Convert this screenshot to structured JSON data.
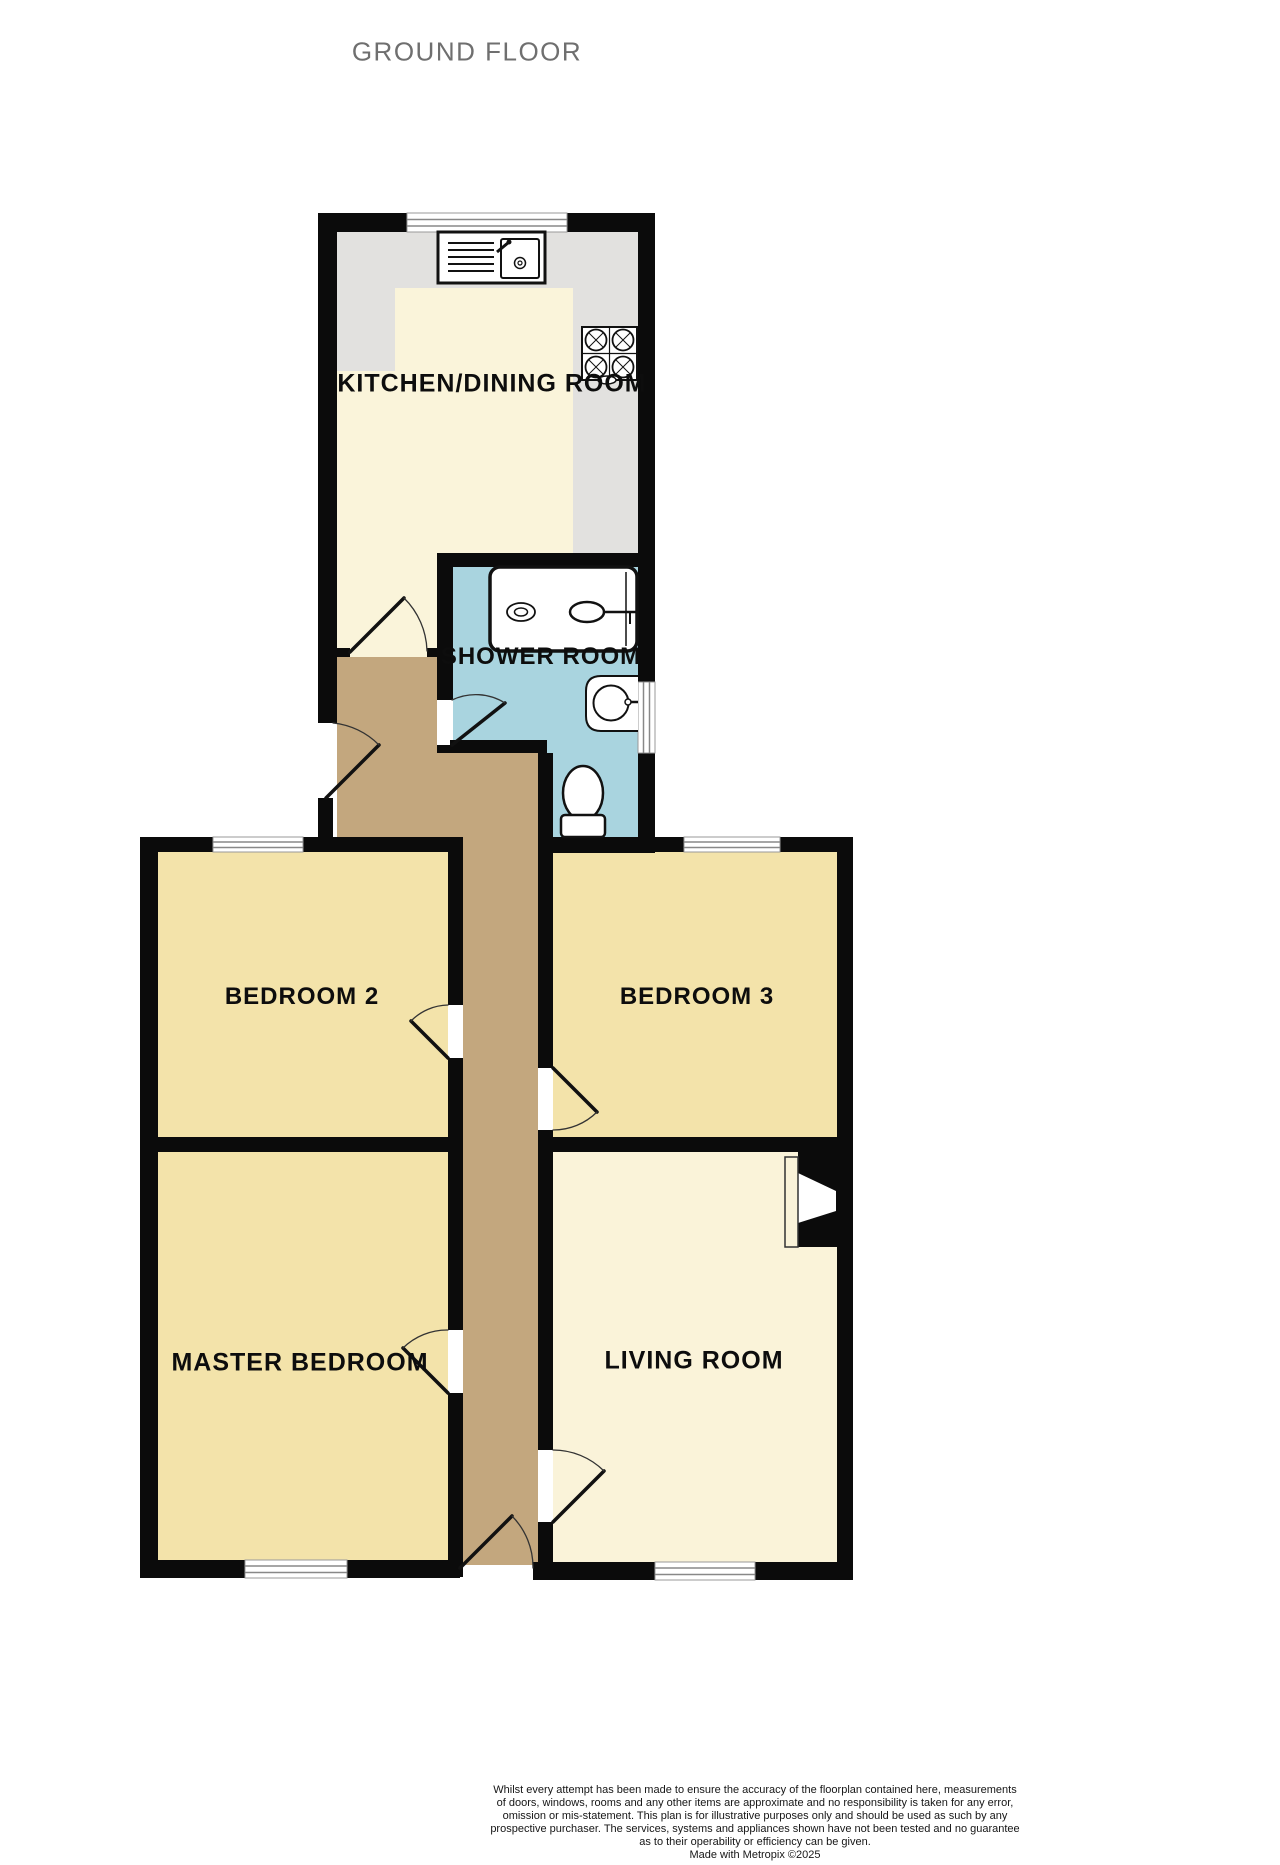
{
  "title": "GROUND FLOOR",
  "rooms": {
    "kitchen_dining": "KITCHEN/DINING ROOM",
    "shower_room": "SHOWER ROOM",
    "bedroom_2": "BEDROOM 2",
    "bedroom_3": "BEDROOM 3",
    "master_bedroom": "MASTER BEDROOM",
    "living_room": "LIVING ROOM"
  },
  "colors": {
    "wall": "#0b0b0b",
    "kitchen_floor": "#faf4da",
    "counter_gray": "#e2e1df",
    "bedroom_floor": "#f3e3aa",
    "living_room_floor": "#faf3d9",
    "hallway_floor": "#c3a77e",
    "shower_room_floor": "#a9d4df",
    "title_text": "#6f6f6f"
  },
  "fixtures": [
    "sink-icon",
    "hob-icon",
    "shower-cubicle-icon",
    "wash-basin-icon",
    "toilet-icon",
    "fireplace-icon"
  ],
  "disclaimer_lines": [
    "Whilst every attempt has been made to ensure the accuracy of the floorplan contained here, measurements",
    "of doors, windows, rooms and any other items are approximate and no responsibility is taken for any error,",
    "omission or mis-statement. This plan is for illustrative purposes only and should be used as such by any",
    "prospective purchaser. The services, systems and appliances shown have not been tested and no guarantee",
    "as to their operability or efficiency can be given."
  ],
  "credit": "Made with Metropix ©2025"
}
